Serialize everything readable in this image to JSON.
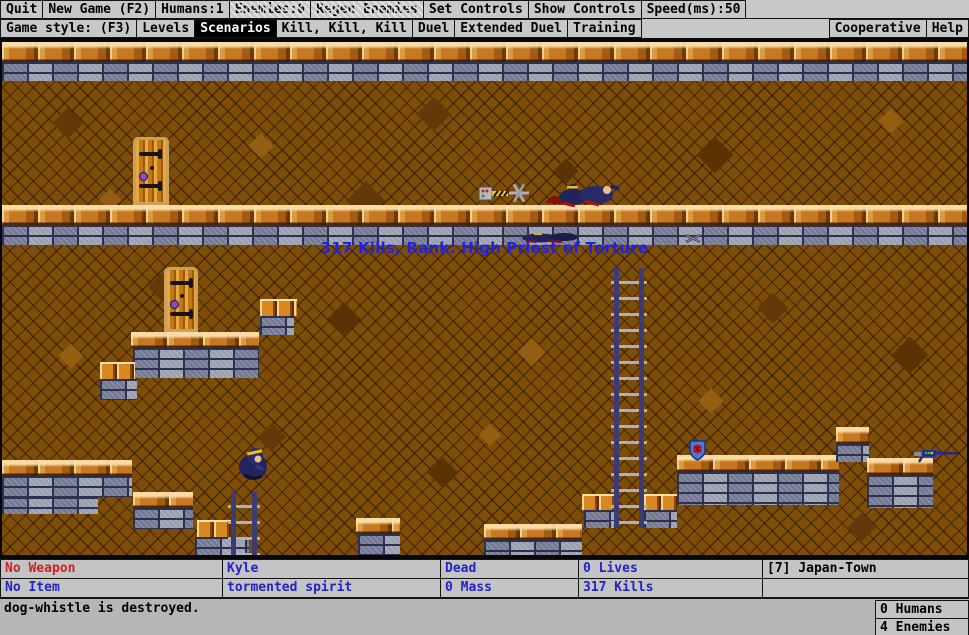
{
  "menu_row1": {
    "items": [
      {
        "label": "Quit"
      },
      {
        "label": "New Game (F2)"
      },
      {
        "label": "Humans:1"
      },
      {
        "label": "Enemies:0",
        "disabled": true
      },
      {
        "label": "Regen Enemies",
        "disabled": true
      },
      {
        "label": "Set Controls"
      },
      {
        "label": "Show Controls"
      },
      {
        "label": "Speed(ms):50"
      }
    ]
  },
  "menu_row2": {
    "left": [
      {
        "label": "Game style: (F3)"
      },
      {
        "label": "Levels"
      },
      {
        "label": "Scenarios",
        "selected": true
      },
      {
        "label": "Kill, Kill, Kill"
      },
      {
        "label": "Duel"
      },
      {
        "label": "Extended Duel"
      },
      {
        "label": "Training"
      }
    ],
    "right": [
      {
        "label": "Cooperative"
      },
      {
        "label": "Help"
      }
    ]
  },
  "game": {
    "overlay_text": "317 Kills, Rank: High Priest of Torture"
  },
  "status": {
    "weapon": "No Weapon",
    "item": "No Item",
    "player_name": "Kyle",
    "player_class": "tormented spirit",
    "state": "Dead",
    "mass": "0 Mass",
    "lives": "0 Lives",
    "kills": "317 Kills",
    "level": "[7] Japan-Town",
    "message": "dog-whistle is destroyed.",
    "humans": "0 Humans",
    "enemies": "4 Enemies"
  },
  "colors": {
    "status_blue": "#2222cc",
    "status_red": "#cc2222",
    "overlay_blue": "#2222dd",
    "menu_bg": "#c8c8c8",
    "selected_bg": "#000000"
  }
}
